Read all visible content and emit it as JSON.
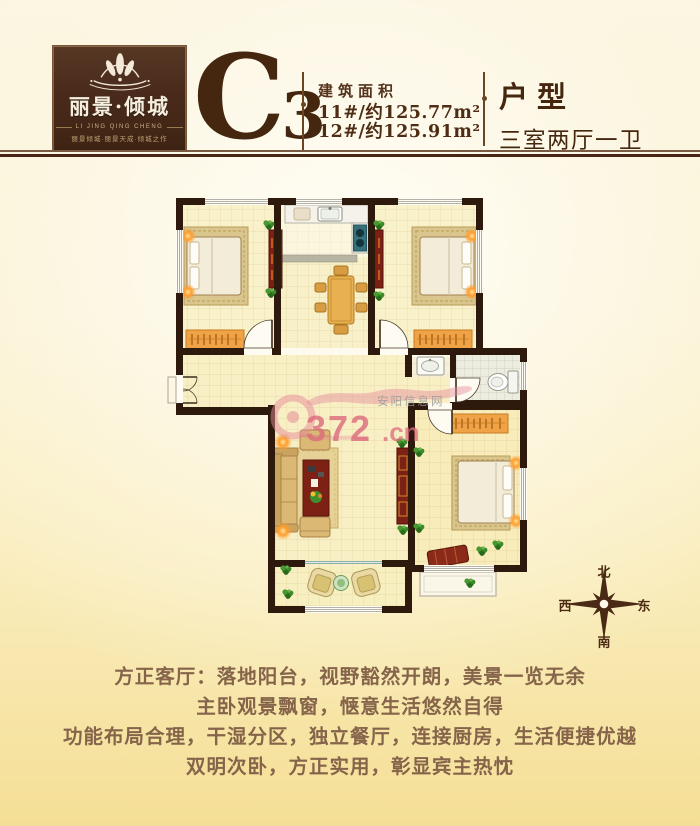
{
  "header": {
    "logo": {
      "title": "丽景·倾城",
      "tagline_en": "LI JING QING CHENG",
      "tagline_cn": "丽景倾城·丽景天成·倾城之作"
    },
    "unit_code": "C",
    "unit_code_sub": "3",
    "area": {
      "label": "建筑面积",
      "lines": [
        "11#/约125.77m²",
        "12#/约125.91m²"
      ]
    },
    "type": {
      "label": "户型",
      "value": "三室两厅一卫"
    }
  },
  "watermark": {
    "text_number": "372",
    "text_domain": ".cn",
    "site": "安阳信息网"
  },
  "compass": {
    "north": "北",
    "south": "南",
    "west": "西",
    "east": "东"
  },
  "description": {
    "lines": [
      "方正客厅：落地阳台，视野豁然开朗，美景一览无余",
      "主卧观景飘窗，惬意生活悠然自得",
      "功能布局合理，干湿分区，独立餐厅，连接厨房，生活便捷优越",
      "双明次卧，方正实用，彰显宾主热忱"
    ]
  },
  "colors": {
    "accent_brown": "#482515",
    "wall": "#2e1a0d",
    "logo_bg": "#4a2b1b",
    "floor_cream": "#f9f1ca",
    "watermark_pink": "#e2717f",
    "text_brown": "#85644a"
  }
}
